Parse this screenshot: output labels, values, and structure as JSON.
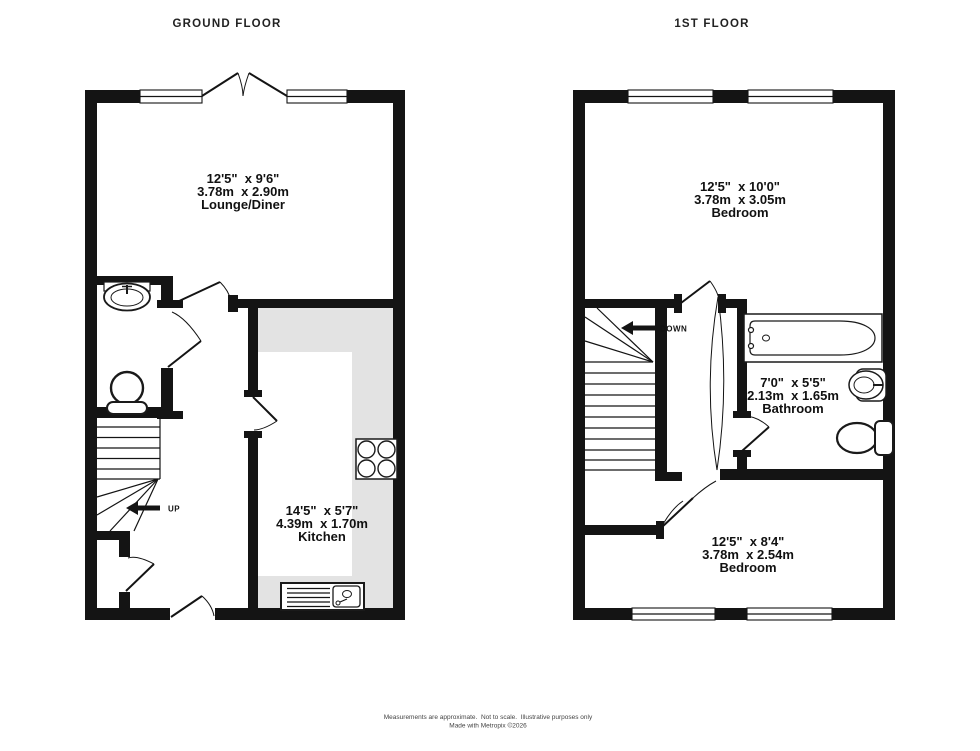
{
  "titles": {
    "ground_floor": "GROUND FLOOR",
    "first_floor": "1ST FLOOR"
  },
  "ground_floor": {
    "lounge_diner": {
      "imperial": "12'5\"  x 9'6\"",
      "metric": "3.78m  x 2.90m",
      "label": "Lounge/Diner"
    },
    "kitchen": {
      "imperial": "14'5\"  x 5'7\"",
      "metric": "4.39m  x 1.70m",
      "label": "Kitchen"
    },
    "stair_direction": "UP"
  },
  "first_floor": {
    "bedroom_front": {
      "imperial": "12'5\"  x 10'0\"",
      "metric": "3.78m  x 3.05m",
      "label": "Bedroom"
    },
    "bathroom": {
      "imperial": "7'0\"  x 5'5\"",
      "metric": "2.13m  x 1.65m",
      "label": "Bathroom"
    },
    "bedroom_rear": {
      "imperial": "12'5\"  x 8'4\"",
      "metric": "3.78m  x 2.54m",
      "label": "Bedroom"
    },
    "stair_direction": "DOWN"
  },
  "footer": {
    "disclaimer": "Measurements are approximate.  Not to scale.  Illustrative purposes only",
    "credit": "Made with Metropix ©2026"
  },
  "colors": {
    "wall": "#141414",
    "counter": "#e3e3e3",
    "text": "#111111",
    "footer": "#444444",
    "background": "#ffffff"
  }
}
